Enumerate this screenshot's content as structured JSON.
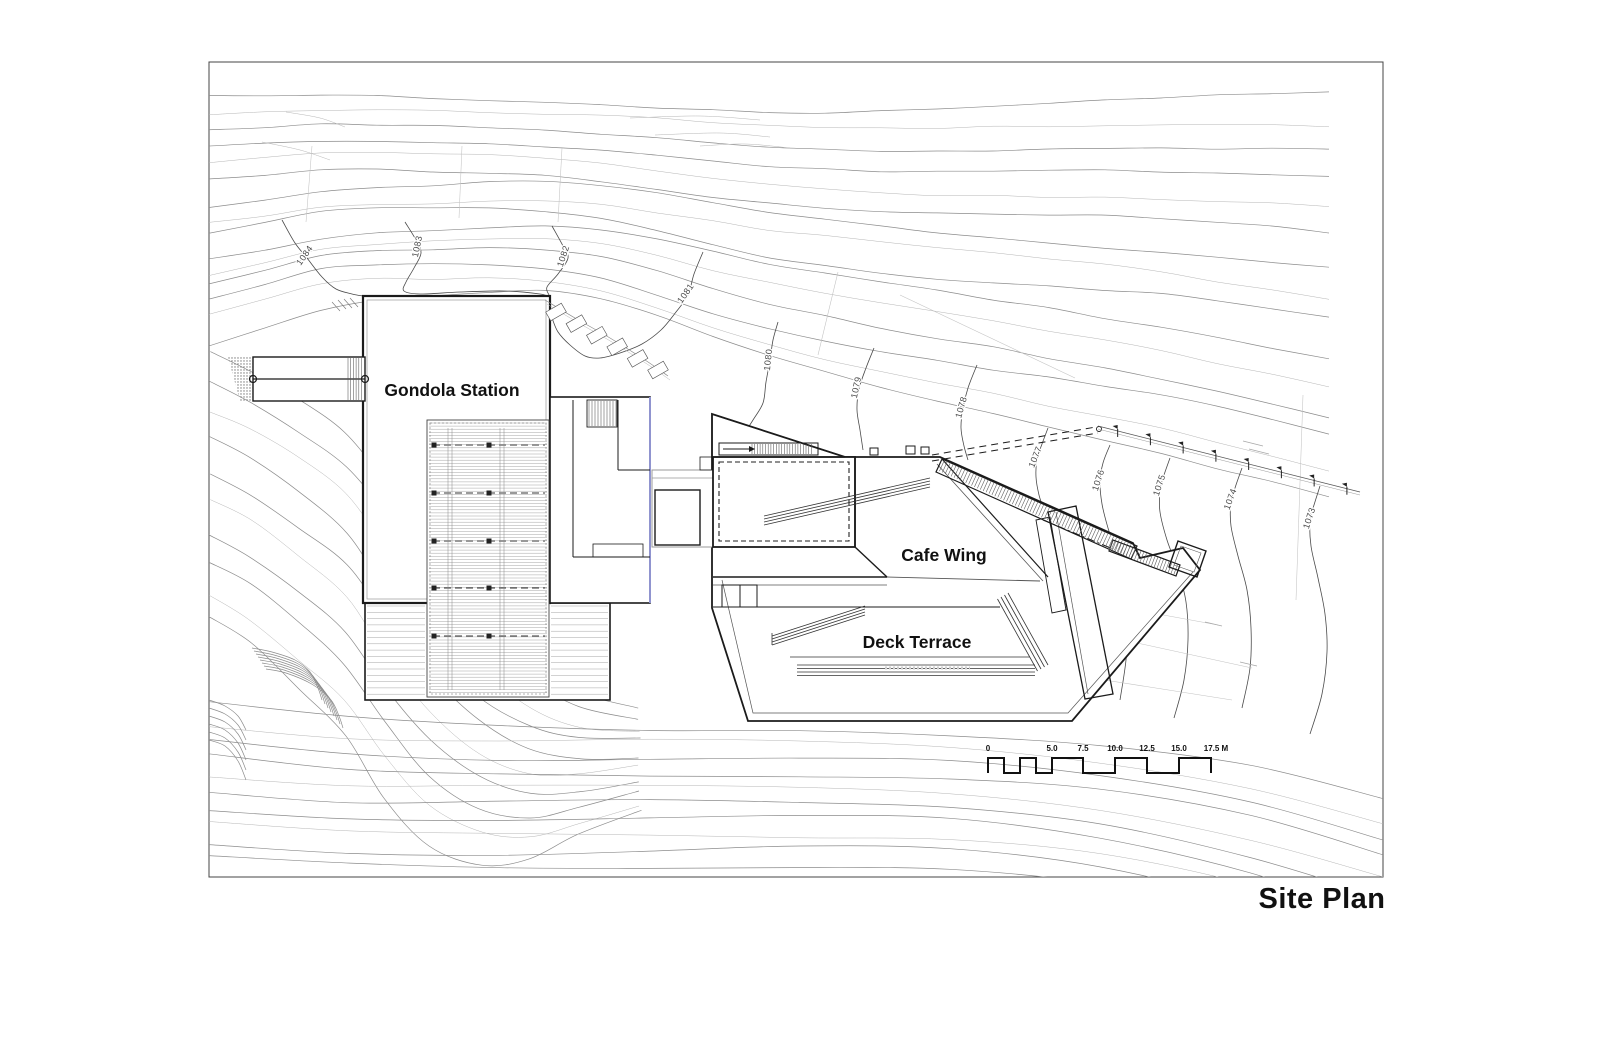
{
  "page": {
    "title": "Site Plan"
  },
  "buildings": {
    "gondola_station": "Gondola Station",
    "cafe_wing": "Cafe Wing",
    "deck_terrace": "Deck Terrace"
  },
  "contour_labels": [
    "1084",
    "1083",
    "1082",
    "1081",
    "1080",
    "1079",
    "1078",
    "1077",
    "1076",
    "1075",
    "1074",
    "1073"
  ],
  "scale_bar": {
    "labels": [
      "0",
      "5.0",
      "7.5",
      "10.0",
      "12.5",
      "15.0",
      "17.5 M"
    ]
  },
  "colors": {
    "paper": "#ffffff",
    "drawing_line": "#1b1b1b",
    "contour": "#8c8c8c",
    "contour_light": "#b5b5b5",
    "accent_blue": "#9094cf"
  }
}
